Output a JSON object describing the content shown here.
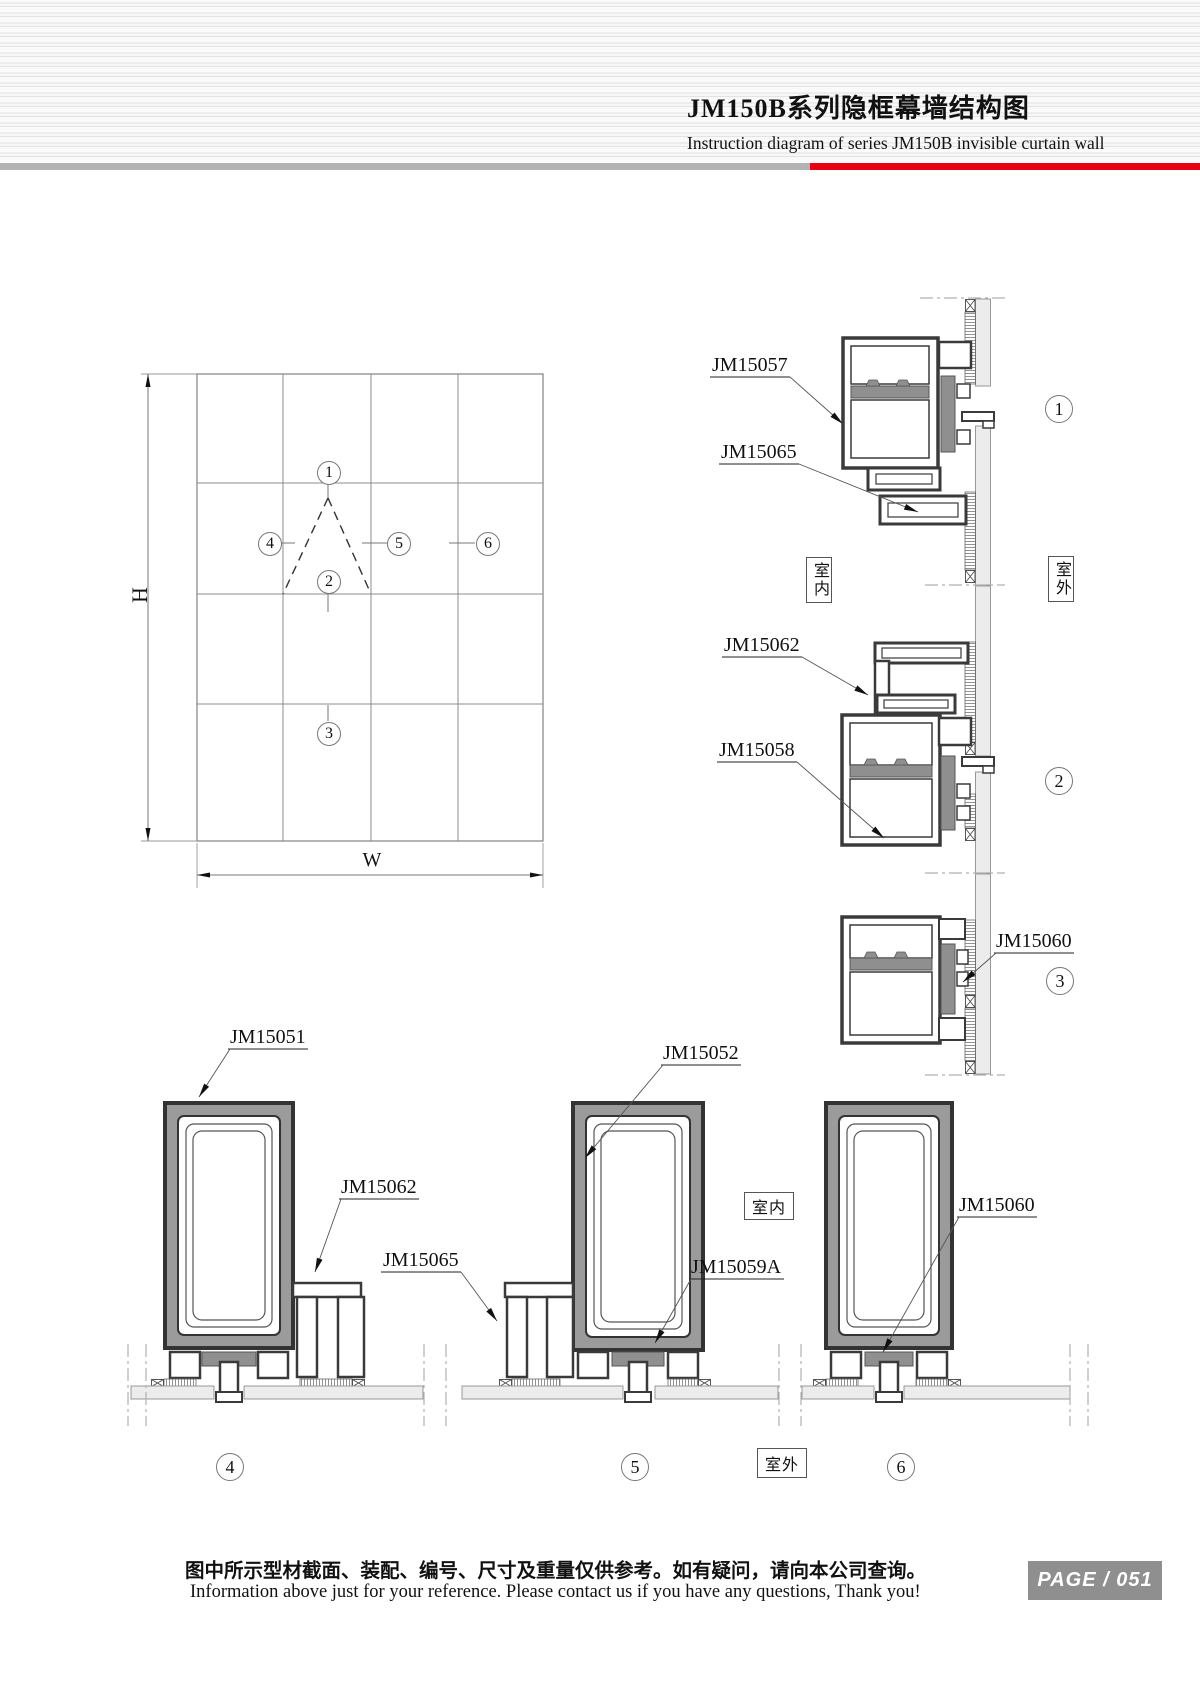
{
  "header": {
    "title_cn": "JM150B系列隐框幕墙结构图",
    "subtitle_en": "Instruction diagram of series JM150B invisible curtain wall"
  },
  "elevation": {
    "height_label": "H",
    "width_label": "W"
  },
  "markers": {
    "m1": "1",
    "m2": "2",
    "m3": "3",
    "m4": "4",
    "m5": "5",
    "m6": "6"
  },
  "room_labels": {
    "indoor": "室内",
    "outdoor": "室外"
  },
  "callouts": {
    "jm15057": "JM15057",
    "jm15065": "JM15065",
    "jm15062": "JM15062",
    "jm15058": "JM15058",
    "jm15060": "JM15060",
    "jm15051": "JM15051",
    "jm15052": "JM15052",
    "jm15059a": "JM15059A"
  },
  "footer": {
    "note_cn": "图中所示型材截面、装配、编号、尺寸及重量仅供参考。如有疑问，请向本公司查询。",
    "note_en": "Information above just for your reference. Please contact us if you have any questions, Thank you!",
    "page_label": "PAGE / 051"
  },
  "colors": {
    "accent_red": "#e60012",
    "bar_gray": "#b3b3b3",
    "badge_gray": "#8f8f8f",
    "profile_gray": "#8f8f8f"
  }
}
